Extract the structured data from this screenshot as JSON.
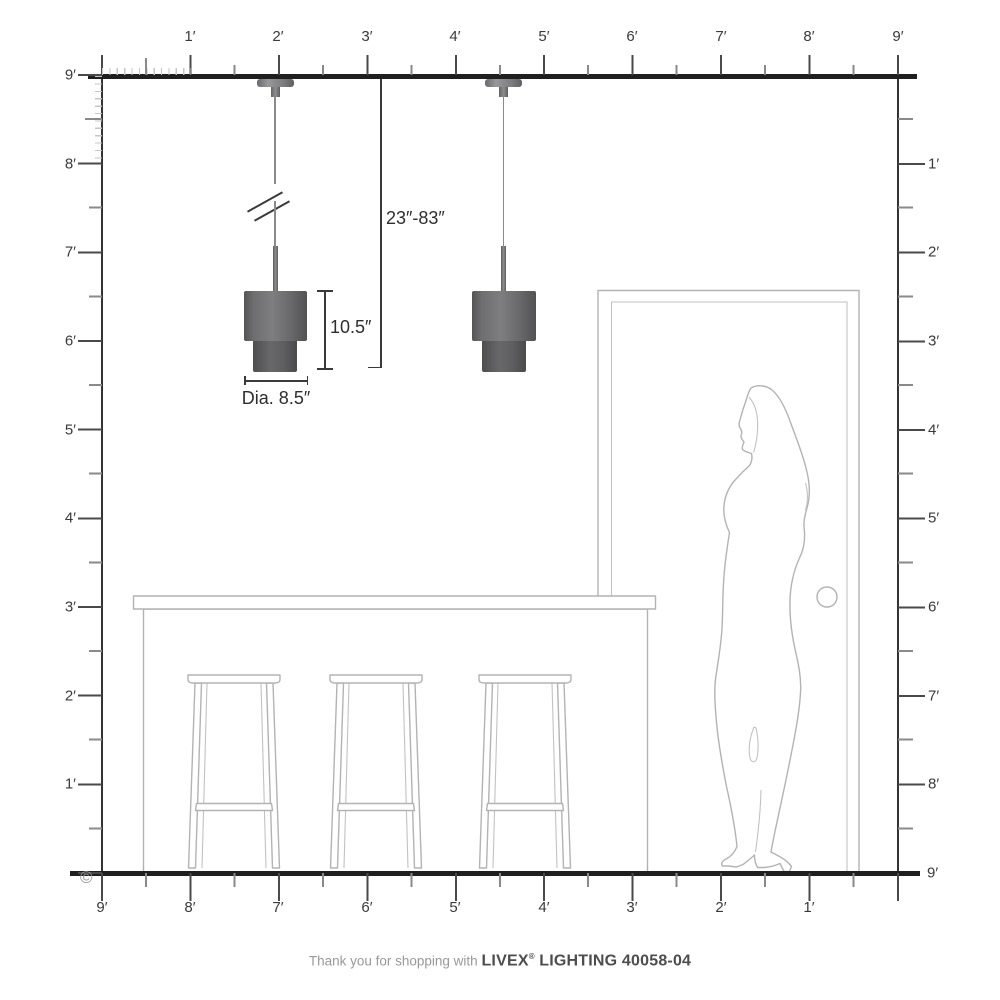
{
  "rulers": {
    "top_labels": [
      "1′",
      "2′",
      "3′",
      "4′",
      "5′",
      "6′",
      "7′",
      "8′",
      "9′"
    ],
    "left_labels": [
      "9′",
      "8′",
      "7′",
      "6′",
      "5′",
      "4′",
      "3′",
      "2′",
      "1′"
    ],
    "right_labels": [
      "1′",
      "2′",
      "3′",
      "4′",
      "5′",
      "6′",
      "7′",
      "8′"
    ],
    "bottom_labels": [
      "9′",
      "8′",
      "7′",
      "6′",
      "5′",
      "4′",
      "3′",
      "2′",
      "1′"
    ],
    "floor_right_label": "9′"
  },
  "annotations": {
    "drop_range": "23″-83″",
    "fixture_height": "10.5″",
    "fixture_diameter": "Dia. 8.5″"
  },
  "footer": {
    "thanks_text": "Thank you for shopping with ",
    "brand": "LIVEX",
    "registered": "®",
    "product": " LIGHTING 40058-04"
  },
  "copyright_symbol": "©",
  "colors": {
    "ruler_line": "#1f1f1f",
    "tick_major": "#4a4a4a",
    "tick_minor": "#8a8a8a",
    "tick_fine": "#c6c6c6",
    "label_text": "#3a3a3a",
    "dimension_text": "#2e2e2e",
    "outline_gray": "#b3b3b3",
    "pendant_gray": "#6c6c6e",
    "footer_light": "#999999",
    "footer_dark": "#4d4d4d"
  }
}
